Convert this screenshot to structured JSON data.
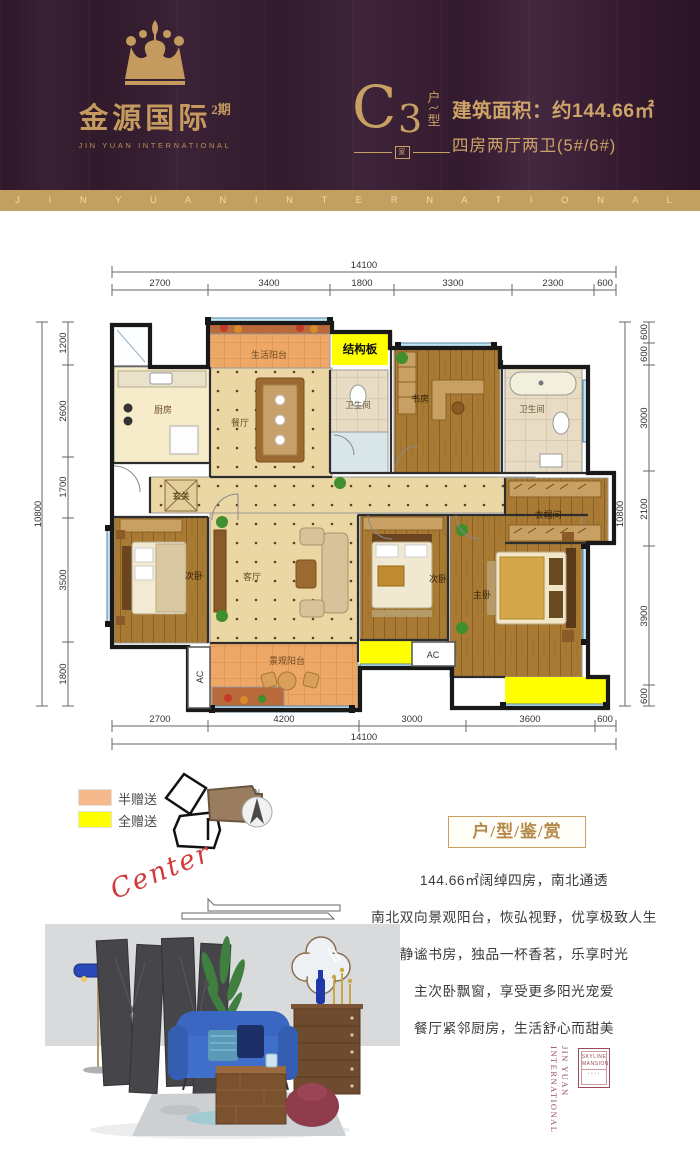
{
  "header": {
    "logo": {
      "brand_cn": "金源国际",
      "phase": "2期",
      "brand_en": "JIN YUAN INTERNATIONAL"
    },
    "unit_type": {
      "letter": "C",
      "number": "3",
      "hu": "户",
      "xing": "型",
      "jia": "家"
    },
    "area_text": "建筑面积：约144.66㎡",
    "rooms_text": "四房两厅两卫(5#/6#)",
    "banner_text": "J I N Y U A N I N T E R N A T I O N A L"
  },
  "floor_plan": {
    "dims": {
      "top_total": "14100",
      "top_segments": [
        "2700",
        "3400",
        "1800",
        "3300",
        "2300",
        "600"
      ],
      "bottom_segments": [
        "2700",
        "4200",
        "3000",
        "3600",
        "600"
      ],
      "bottom_total": "14100",
      "left_segments": [
        "1200",
        "2600",
        "1700",
        "3500",
        "1800"
      ],
      "left_total": "10800",
      "right_segments": [
        "600",
        "600",
        "3000",
        "2100",
        "3900",
        "600"
      ],
      "right_total": "10800"
    },
    "rooms": {
      "life_balcony": "生活阳台",
      "structural_board": "结构板",
      "kitchen": "厨房",
      "dining": "餐厅",
      "bath_small": "卫生间",
      "study": "书房",
      "bath_main": "卫生间",
      "entry": "玄关",
      "cloakroom": "衣帽间",
      "bedroom_left": "次卧",
      "living": "客厅",
      "bedroom_mid": "次卧",
      "master": "主卧",
      "view_balcony": "景观阳台",
      "ac": "AC"
    }
  },
  "legend": {
    "half_gift": {
      "label": "半赠送",
      "color": "#f5b98c"
    },
    "full_gift": {
      "label": "全赠送",
      "color": "#ffff00"
    },
    "compass_n": "N"
  },
  "appreciation": {
    "title": "户/型/鉴/赏",
    "script_word": "Center",
    "lines": [
      "144.66㎡阔绰四房，南北通透",
      "南北双向景观阳台，恢弘视野，优享极致人生",
      "静谧书房，独品一杯香茗，乐享时光",
      "主次卧飘窗，享受更多阳光宠爱",
      "餐厅紧邻厨房，生活舒心而甜美"
    ]
  },
  "stamp": {
    "vertical": "JIN YUAN INTERNATIONAL",
    "line1": "SKYLINE",
    "line2": "MANSION",
    "dots": "····"
  },
  "colors": {
    "header_bg": "#37202f",
    "gold": "#c49a5e",
    "banner": "#c2a05f",
    "full_gift": "#ffff00",
    "half_gift": "#f5b98c",
    "script_red": "#d03a3a",
    "stamp_red": "#9a4a58"
  }
}
